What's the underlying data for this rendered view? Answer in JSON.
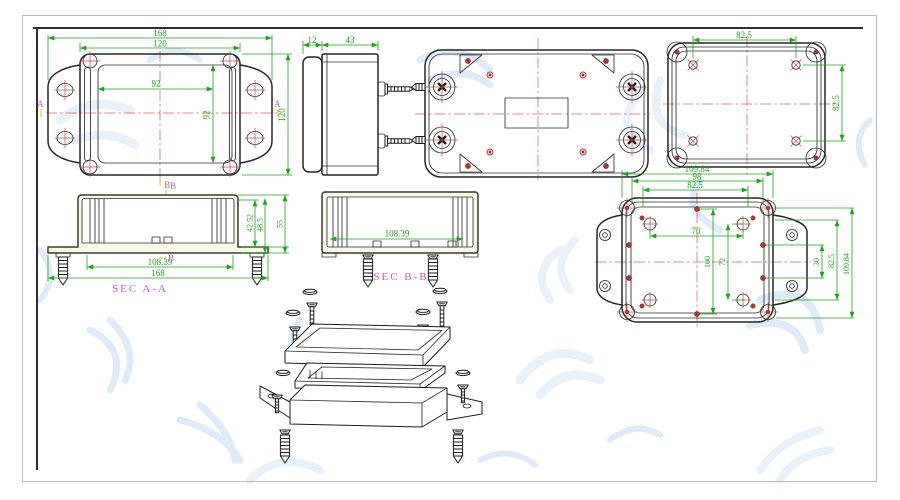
{
  "drawing": {
    "kind": "CAD multi-view enclosure drawing",
    "views": [
      "front",
      "side",
      "bottom",
      "top",
      "section A-A",
      "section B-B",
      "back",
      "exploded"
    ]
  },
  "colors": {
    "outline": "#262626",
    "dimension_green": "#1fa31f",
    "centerline_red": "#e05c5c",
    "screw_red": "#cc4444",
    "section_magenta": "#c45fc4",
    "marker_yellow": "#d9cf30",
    "border_gray": "#b6bcc2",
    "frame_dark": "#2e2e2e",
    "watermark_blue": "#e4eefa",
    "section_fill": "#faf8e9"
  },
  "views": {
    "front": {
      "dims": {
        "outer_width": "168",
        "body_width": "120",
        "lid_width": "92",
        "lid_height": "92",
        "height": "120"
      },
      "markers": {
        "left": "A",
        "right": "A",
        "bottom": "B"
      }
    },
    "side": {
      "dims": {
        "flange_depth": "12",
        "body_depth": "43"
      }
    },
    "top": {
      "dims": {
        "width": "82.5",
        "height": "82.5"
      }
    },
    "section_aa": {
      "label": "SEC A-A",
      "marker_top": "B",
      "marker_bottom": "B",
      "dims": {
        "inner_depth": "42.52",
        "mid_depth": "48.5",
        "total_height": "55",
        "inner_width": "108.39",
        "total_width": "168"
      }
    },
    "section_bb": {
      "label": "SEC B-B",
      "dims": {
        "inner_width": "108.39"
      }
    },
    "back": {
      "dims": {
        "total_width": "109.84",
        "hole_span_width": "98",
        "lid_width": "82.5",
        "inner_hole_width": "70",
        "inner_height_outer": "100",
        "inner_hole_height": "72",
        "right_small": "30",
        "lid_height": "82.5",
        "total_height": "109.84"
      }
    }
  }
}
